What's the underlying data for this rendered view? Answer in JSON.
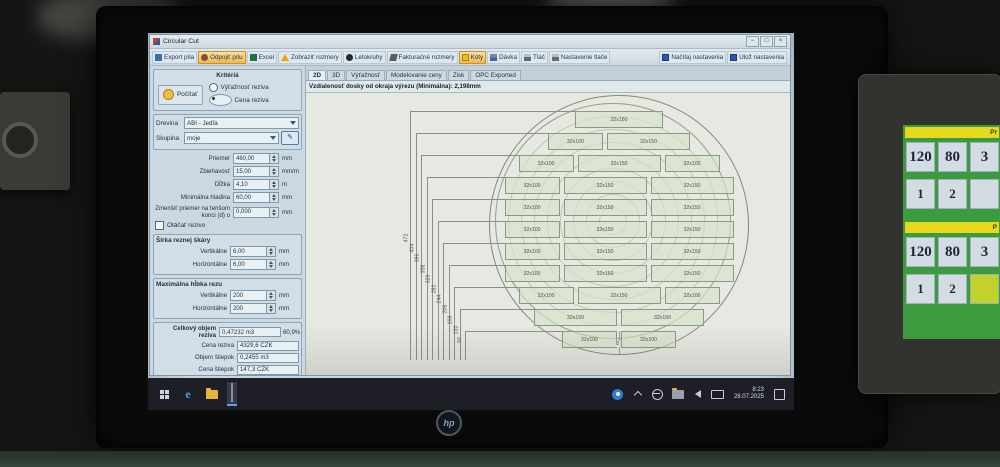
{
  "taskbar": {
    "time": "8:23",
    "date": "28.07.2025"
  },
  "laptop": {
    "logo": "hp"
  },
  "window": {
    "title": "Circular Cut",
    "controls": {
      "minimize": "−",
      "maximize": "□",
      "close": "×"
    },
    "toolbar": {
      "items": [
        {
          "label": "Export píla",
          "icon": "export-icon",
          "highlighted": false
        },
        {
          "label": "Odpojiť pílu",
          "icon": "disconnect-saw-icon",
          "highlighted": true
        },
        {
          "label": "Excel",
          "icon": "excel-icon",
          "highlighted": false
        },
        {
          "label": "Zobraziť rozmery",
          "icon": "warning-icon",
          "highlighted": false
        },
        {
          "label": "Letokruhy",
          "icon": "rings-icon",
          "highlighted": false
        },
        {
          "label": "Fakturačné rozmery",
          "icon": "saw-icon",
          "highlighted": false
        },
        {
          "label": "Kóty",
          "icon": "dimensions-icon",
          "highlighted": true
        },
        {
          "label": "Dávka",
          "icon": "batch-icon",
          "highlighted": false
        },
        {
          "label": "Tlač",
          "icon": "print-icon",
          "highlighted": false
        },
        {
          "label": "Nastavenie tlače",
          "icon": "print-settings-icon",
          "highlighted": false
        }
      ],
      "right": [
        {
          "label": "Načítaj nastavenia",
          "icon": "load-icon"
        },
        {
          "label": "Ulož nastavenia",
          "icon": "save-icon"
        }
      ]
    },
    "criteria": {
      "title": "Kritériá",
      "button": "Počítať",
      "options": [
        {
          "label": "Výťažnosť reziva",
          "selected": false
        },
        {
          "label": "Cena reziva",
          "selected": true
        }
      ]
    },
    "selectors": [
      {
        "label": "Drevina",
        "value": "ABI - Jedľa"
      },
      {
        "label": "Skupina",
        "value": "moje",
        "edit_glyph": "✎"
      }
    ],
    "fields": [
      {
        "label": "Priemer",
        "value": "460,00",
        "unit": "mm"
      },
      {
        "label": "Zbiehavosť",
        "value": "15,00",
        "unit": "mm/m"
      },
      {
        "label": "Dĺžka",
        "value": "4,10",
        "unit": "m"
      },
      {
        "label": "Minimálna hladina",
        "value": "60,00",
        "unit": "mm"
      },
      {
        "label": "Zmenšiť priemer na tenšom konci (d) o",
        "value": "0,000",
        "unit": "mm"
      }
    ],
    "rotate_checkbox": {
      "label": "Otáčať rezivo",
      "checked": false
    },
    "kerf_group": {
      "title": "Šírka reznej škáry",
      "fields": [
        {
          "label": "Vertikálne",
          "value": "6,00",
          "unit": "mm"
        },
        {
          "label": "Horizontálne",
          "value": "6,00",
          "unit": "mm"
        }
      ]
    },
    "depth_group": {
      "title": "Maximálna hĺbka rezu",
      "fields": [
        {
          "label": "Vertikálne",
          "value": "200",
          "unit": "mm"
        },
        {
          "label": "Horizontálne",
          "value": "200",
          "unit": "mm"
        }
      ]
    },
    "totals": {
      "rows": [
        {
          "label": "Celkový objem reziva",
          "value": "0,47232 m3",
          "extra": "60,9%"
        },
        {
          "label": "Cena reziva",
          "value": "4329,6 CZK"
        },
        {
          "label": "Objem štiepok",
          "value": "0,2455 m3"
        },
        {
          "label": "Cena štiepok",
          "value": "147,3 CZK"
        },
        {
          "label": "Objem pilín",
          "value": "0,0577 m3"
        },
        {
          "label": "Cena pilín",
          "value": "35,2 CZK"
        }
      ]
    },
    "tabs": [
      {
        "label": "2D",
        "active": true
      },
      {
        "label": "3D",
        "active": false
      },
      {
        "label": "Výťažnosť",
        "active": false
      },
      {
        "label": "Modelovanie ceny",
        "active": false
      },
      {
        "label": "Zisk",
        "active": false
      },
      {
        "label": "OPC Exported",
        "active": false
      }
    ],
    "info_line": "Vzdialenosť dosky od okraja výrezu (Minimálna): 2,198mm",
    "diagram": {
      "rows": [
        [
          "32x160"
        ],
        [
          "32x100",
          "32x150"
        ],
        [
          "32x100",
          "32x150",
          "32x100"
        ],
        [
          "32x100",
          "32x150",
          "32x150"
        ],
        [
          "32x100",
          "32x150",
          "32x150"
        ],
        [
          "32x100",
          "32x150",
          "32x150"
        ],
        [
          "32x100",
          "32x150",
          "32x150"
        ],
        [
          "32x100",
          "32x150",
          "32x150"
        ],
        [
          "32x100",
          "32x150",
          "32x100"
        ],
        [
          "32x150",
          "32x150"
        ],
        [
          "32x100",
          "32x100"
        ]
      ],
      "dims": [
        "472",
        "434",
        "396",
        "358",
        "320",
        "282",
        "244",
        "206",
        "168",
        "130",
        "92"
      ],
      "bottom_label": "8"
    }
  },
  "hmi": {
    "sections": [
      {
        "header": "Pr",
        "values": [
          "120",
          "80",
          "3"
        ],
        "buttons": [
          "1",
          "2",
          ""
        ],
        "highlighted_button": -1
      },
      {
        "header": "P",
        "values": [
          "120",
          "80",
          "3"
        ],
        "buttons": [
          "1",
          "2",
          ""
        ],
        "highlighted_button": 2
      }
    ]
  }
}
